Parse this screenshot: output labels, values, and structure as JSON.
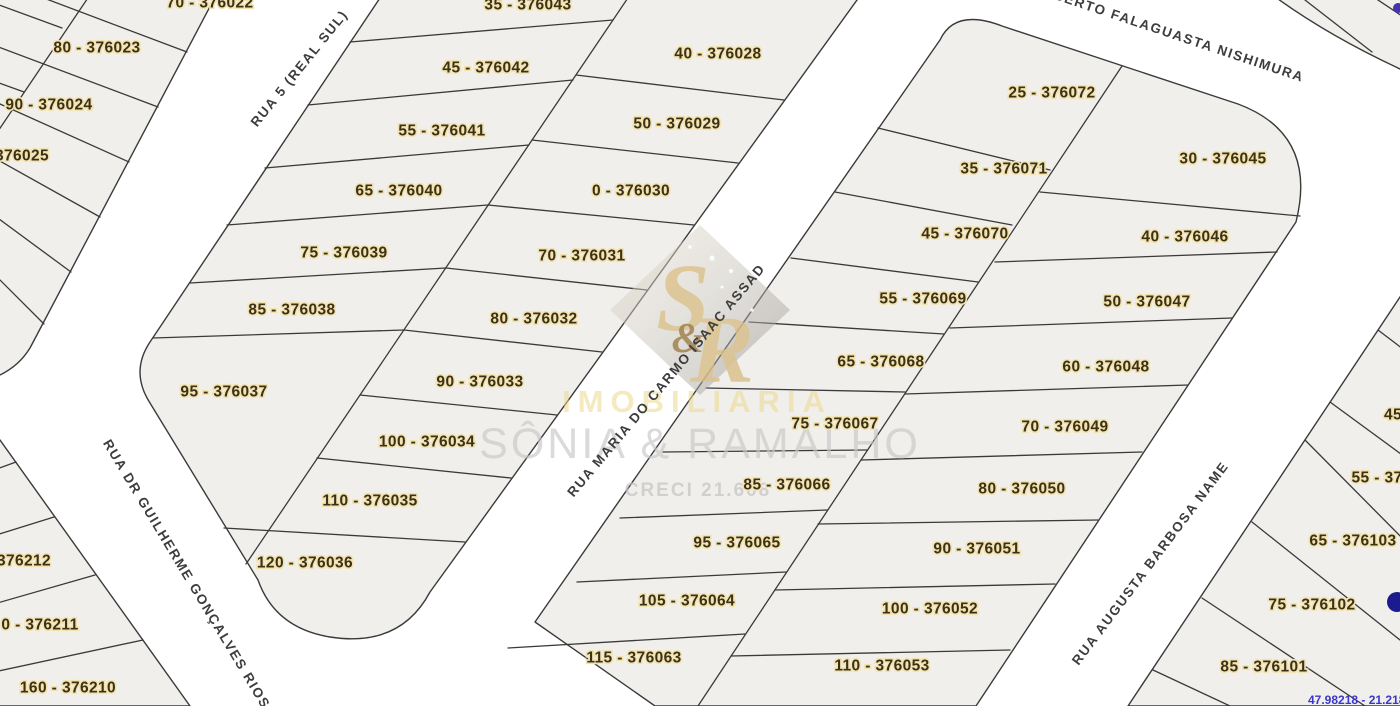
{
  "map": {
    "background_color": "#ffffff",
    "block_fill": "#f1efec",
    "line_color": "#3a3a3a",
    "lot_label_color": "#3a3117",
    "lot_label_halo": "#f3e3b0",
    "blocks": [
      {
        "name": "northwest-block",
        "path": "M -20,-20 L 224,-20 L 30,348 Q 14,374 -20,382 Z"
      },
      {
        "name": "central-block",
        "path": "M 392,-20 L 900,-20 L 870,-18 L 430,592 Q 400,648 330,637 Q 275,628 258,580 L 150,403 Q 130,372 150,342 Z"
      },
      {
        "name": "east-central-block",
        "path": "M 940,40 Q 955,8 1002,26 L 1238,104 Q 1318,134 1296,222 L 976,706 L 655,706 L 535,622 Z"
      },
      {
        "name": "right-edge-block",
        "path": "M 1404,291 L 1420,280 L 1420,706 L 1128,706 Z"
      },
      {
        "name": "top-right-corner-block",
        "path": "M 1253,-20 L 1420,-20 L 1420,78 Q 1320,34 1253,-20 Z"
      },
      {
        "name": "southwest-block",
        "path": "M -20,428 L 0,440 L 190,706 L -20,706 Z"
      }
    ],
    "parcel_lines": [
      [
        187,
        52,
        -20,
        -26
      ],
      [
        158,
        107,
        -20,
        40
      ],
      [
        129,
        162,
        -20,
        95
      ],
      [
        100,
        217,
        -20,
        150
      ],
      [
        71,
        272,
        -20,
        205
      ],
      [
        44,
        324,
        -20,
        260
      ],
      [
        100,
        -20,
        -12,
        146
      ],
      [
        62,
        28,
        -20,
        -2
      ],
      [
        24,
        92,
        -20,
        76
      ],
      [
        350,
        42,
        613,
        20
      ],
      [
        308,
        105,
        573,
        80
      ],
      [
        265,
        168,
        529,
        145
      ],
      [
        227,
        225,
        488,
        205
      ],
      [
        190,
        283,
        446,
        268
      ],
      [
        153,
        338,
        404,
        330
      ],
      [
        640,
        -20,
        246,
        564
      ],
      [
        576,
        75,
        784,
        100
      ],
      [
        532,
        140,
        738,
        163
      ],
      [
        488,
        205,
        694,
        225
      ],
      [
        446,
        268,
        647,
        290
      ],
      [
        404,
        330,
        602,
        352
      ],
      [
        360,
        395,
        557,
        415
      ],
      [
        317,
        458,
        511,
        478
      ],
      [
        224,
        528,
        465,
        542
      ],
      [
        878,
        128,
        1050,
        170
      ],
      [
        835,
        192,
        1012,
        225
      ],
      [
        791,
        258,
        978,
        282
      ],
      [
        749,
        322,
        944,
        334
      ],
      [
        706,
        388,
        905,
        392
      ],
      [
        663,
        452,
        867,
        450
      ],
      [
        620,
        518,
        827,
        510
      ],
      [
        577,
        582,
        786,
        572
      ],
      [
        508,
        648,
        745,
        634
      ],
      [
        1122,
        66,
        698,
        706
      ],
      [
        1040,
        192,
        1300,
        216
      ],
      [
        995,
        262,
        1277,
        252
      ],
      [
        950,
        328,
        1232,
        318
      ],
      [
        905,
        394,
        1188,
        385
      ],
      [
        861,
        460,
        1142,
        452
      ],
      [
        818,
        524,
        1098,
        520
      ],
      [
        775,
        590,
        1055,
        584
      ],
      [
        731,
        656,
        1010,
        650
      ],
      [
        1378,
        330,
        1420,
        362
      ],
      [
        1330,
        402,
        1420,
        468
      ],
      [
        1305,
        440,
        1420,
        556
      ],
      [
        1252,
        522,
        1400,
        640
      ],
      [
        1202,
        598,
        1365,
        706
      ],
      [
        1153,
        670,
        1230,
        706
      ],
      [
        1305,
        0,
        1372,
        52
      ],
      [
        1360,
        -12,
        1420,
        28
      ],
      [
        -20,
        475,
        16,
        462
      ],
      [
        -20,
        540,
        54,
        517
      ],
      [
        -20,
        608,
        95,
        575
      ],
      [
        -20,
        675,
        143,
        640
      ]
    ],
    "lots": [
      {
        "label": "70 - 376022",
        "x": 210,
        "y": 2
      },
      {
        "label": "80 - 376023",
        "x": 97,
        "y": 47
      },
      {
        "label": "90 - 376024",
        "x": 49,
        "y": 104
      },
      {
        "label": "376025",
        "x": 22,
        "y": 155
      },
      {
        "label": "35 - 376043",
        "x": 528,
        "y": 4
      },
      {
        "label": "45 - 376042",
        "x": 486,
        "y": 67
      },
      {
        "label": "55 - 376041",
        "x": 442,
        "y": 130
      },
      {
        "label": "65 - 376040",
        "x": 399,
        "y": 190
      },
      {
        "label": "75 - 376039",
        "x": 344,
        "y": 252
      },
      {
        "label": "85 - 376038",
        "x": 292,
        "y": 309
      },
      {
        "label": "95 - 376037",
        "x": 224,
        "y": 391
      },
      {
        "label": "40 - 376028",
        "x": 718,
        "y": 53
      },
      {
        "label": "50 - 376029",
        "x": 677,
        "y": 123
      },
      {
        "label": "0 - 376030",
        "x": 631,
        "y": 190
      },
      {
        "label": "70 - 376031",
        "x": 582,
        "y": 255
      },
      {
        "label": "80 - 376032",
        "x": 534,
        "y": 318
      },
      {
        "label": "90 - 376033",
        "x": 480,
        "y": 381
      },
      {
        "label": "100 - 376034",
        "x": 427,
        "y": 441
      },
      {
        "label": "110 - 376035",
        "x": 370,
        "y": 500
      },
      {
        "label": "120 - 376036",
        "x": 305,
        "y": 562
      },
      {
        "label": "25 - 376072",
        "x": 1052,
        "y": 92
      },
      {
        "label": "35 - 376071",
        "x": 1004,
        "y": 168
      },
      {
        "label": "45 - 376070",
        "x": 965,
        "y": 233
      },
      {
        "label": "55 - 376069",
        "x": 923,
        "y": 298
      },
      {
        "label": "65 - 376068",
        "x": 881,
        "y": 361
      },
      {
        "label": "75 - 376067",
        "x": 835,
        "y": 423
      },
      {
        "label": "85 - 376066",
        "x": 787,
        "y": 484
      },
      {
        "label": "95 - 376065",
        "x": 737,
        "y": 542
      },
      {
        "label": "105 - 376064",
        "x": 687,
        "y": 600
      },
      {
        "label": "115 - 376063",
        "x": 634,
        "y": 657
      },
      {
        "label": "30 - 376045",
        "x": 1223,
        "y": 158
      },
      {
        "label": "40 - 376046",
        "x": 1185,
        "y": 236
      },
      {
        "label": "50 - 376047",
        "x": 1147,
        "y": 301
      },
      {
        "label": "60 - 376048",
        "x": 1106,
        "y": 366
      },
      {
        "label": "70 - 376049",
        "x": 1065,
        "y": 426
      },
      {
        "label": "80 - 376050",
        "x": 1022,
        "y": 488
      },
      {
        "label": "90 - 376051",
        "x": 977,
        "y": 548
      },
      {
        "label": "100 - 376052",
        "x": 930,
        "y": 608
      },
      {
        "label": "110 - 376053",
        "x": 882,
        "y": 665
      },
      {
        "label": "45",
        "x": 1393,
        "y": 414
      },
      {
        "label": "55 - 37",
        "x": 1377,
        "y": 477
      },
      {
        "label": "65 - 376103",
        "x": 1353,
        "y": 540
      },
      {
        "label": "75 - 376102",
        "x": 1312,
        "y": 604
      },
      {
        "label": "85 - 376101",
        "x": 1264,
        "y": 666
      },
      {
        "label": "376212",
        "x": 24,
        "y": 560
      },
      {
        "label": "0 - 376211",
        "x": 40,
        "y": 624
      },
      {
        "label": "160 - 376210",
        "x": 68,
        "y": 687
      }
    ],
    "streets": [
      {
        "name": "RUA 5 (REAL SUL)",
        "x": 299,
        "y": 68,
        "angle": -51
      },
      {
        "name": "ROBERTO FALAGUASTA NISHIMURA",
        "x": 1168,
        "y": 32,
        "angle": 18.5
      },
      {
        "name": "RUA MARIA DO CARMO ISAAC ASSAD",
        "x": 666,
        "y": 380,
        "angle": -50
      },
      {
        "name": "RUA DR GUILHERME GONÇALVES RIOS",
        "x": 187,
        "y": 574,
        "angle": 59
      },
      {
        "name": "RUA AUGUSTA BARBOSA NAME",
        "x": 1150,
        "y": 563,
        "angle": -53
      }
    ],
    "markers": [
      {
        "name": "map-pin-dot",
        "x": 1397,
        "y": 602,
        "r": 10,
        "color": "#1b1b8f"
      },
      {
        "name": "map-pin-dot-small",
        "x": 1398,
        "y": 8,
        "r": 5,
        "color": "#4433aa"
      }
    ],
    "corner_text": {
      "text": "47.98218 - 21.218",
      "x": 1308,
      "y": 704,
      "color": "#3838cc"
    }
  },
  "watermark": {
    "initial_s": "S",
    "initial_r": "R",
    "ampersand": "&",
    "line1": "IMOBILIARIA",
    "line2": "SÔNIA & RAMALHO",
    "line3": "CRECI 21.608",
    "gold_color": "#d9bf8a",
    "gray_color": "#c6c6c6"
  }
}
